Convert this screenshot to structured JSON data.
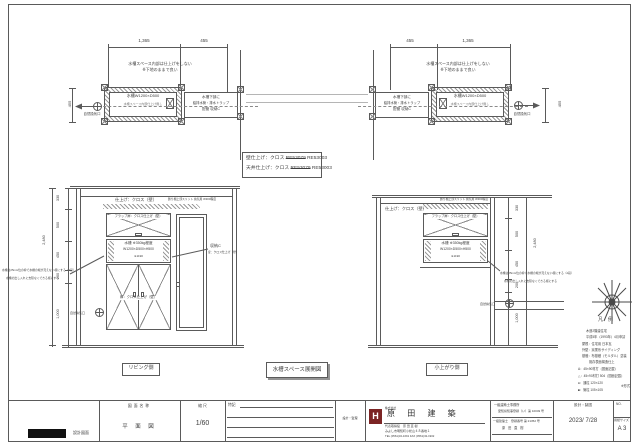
{
  "plan": {
    "note1": "水槽スペース内部は仕上げをしない",
    "note2": "※下地のままで良い",
    "tank_label": "水槽W1200×D500",
    "tank_sub": "水槽スペース内部仕上げ無し",
    "store_line1": "水槽下部に",
    "store_line2": "給排水管・排水トラップ",
    "store_line3": "配管 収納C",
    "vent_label": "自然換気口",
    "left_dim_a": "1,365",
    "left_dim_b": "455",
    "left_dim_side": "455",
    "right_dim_a": "455",
    "right_dim_b": "1,365",
    "right_dim_side": "455"
  },
  "finish": {
    "wall_label": "壁仕上げ：クロス",
    "ceiling_label": "天井仕上げ：クロス",
    "old_code": "RE53079",
    "new_code": "RE53003"
  },
  "elev": {
    "wall_finish": "仕上げ：クロス（壁）",
    "slit_note": "飾り棚上部スリット 換気用 W300程度",
    "flap_label": "フラップ扉：クロス仕上げ（壁）",
    "tank_line1": "水槽 ※350kg程度",
    "tank_line2": "W1200×D500×H500",
    "tank_line3": "※1190",
    "door_label": "扉：クロス仕上げ（壁）",
    "storage_name": "収納C",
    "storage_door": "扉：クロス仕上げ（壁）",
    "note_line1": "水槽は25mm位の枠で水槽の端が見えない様にする（2段）",
    "note_line2": "水槽の出し入れに支障なくできる様にする",
    "vent_label": "自然換気口",
    "dims": [
      "330",
      "500",
      "450",
      "200",
      "1,000"
    ],
    "total": "2,480",
    "caption_left": "リビング側",
    "caption_center": "水槽スペース展開図",
    "caption_right": "小上がり側"
  },
  "legend": {
    "title": "凡　例",
    "lines": [
      "木造2階建住宅",
      "平成5年（1993年）4月申請",
      "屋根：住宅用 日本瓦",
      "外壁：窯業系サイディング",
      "基礎：布基礎（モルタル）塗装",
      "既存表面構造仕上",
      "A：45×90材打（図面記載）",
      "△：45×90材打 504（図面記載）",
      "●：通柱 120×120",
      "■：管柱 105×105"
    ],
    "side_note": "※形式"
  },
  "titleblock": {
    "doc_label": "設計図面",
    "name_header": "図面名称",
    "name_value": "平 面 図",
    "scale_header": "縮 尺",
    "scale_value": "1/60",
    "notes_header": "特記",
    "supervise_header": "設計・監理",
    "company_prefix": "株式会社",
    "company_name": "原 田 建 築",
    "logo_letter": "H",
    "rep_line": "代表取締役　原 田 直 樹",
    "addr_line": "みよし市明知町小松山４８番地１",
    "tel_line": "TEL (0561)32-1691 FAX (0561)32-1902",
    "office_line1": "一級建築士事務所",
    "office_line2": "愛知県知事登録（い）第 10049 号",
    "office_line3": "一級建築士　登録番号 第 21352 号",
    "office_line4": "原 田 直 樹",
    "draft_header": "設計・製図",
    "draft_value": "2023/ 7/28",
    "no_header": "NO.",
    "paper_header": "用紙サイズ",
    "paper_value": "A 3"
  },
  "colors": {
    "line": "#5a5a5a",
    "logo": "#7b2424",
    "redaction": "#111111"
  }
}
